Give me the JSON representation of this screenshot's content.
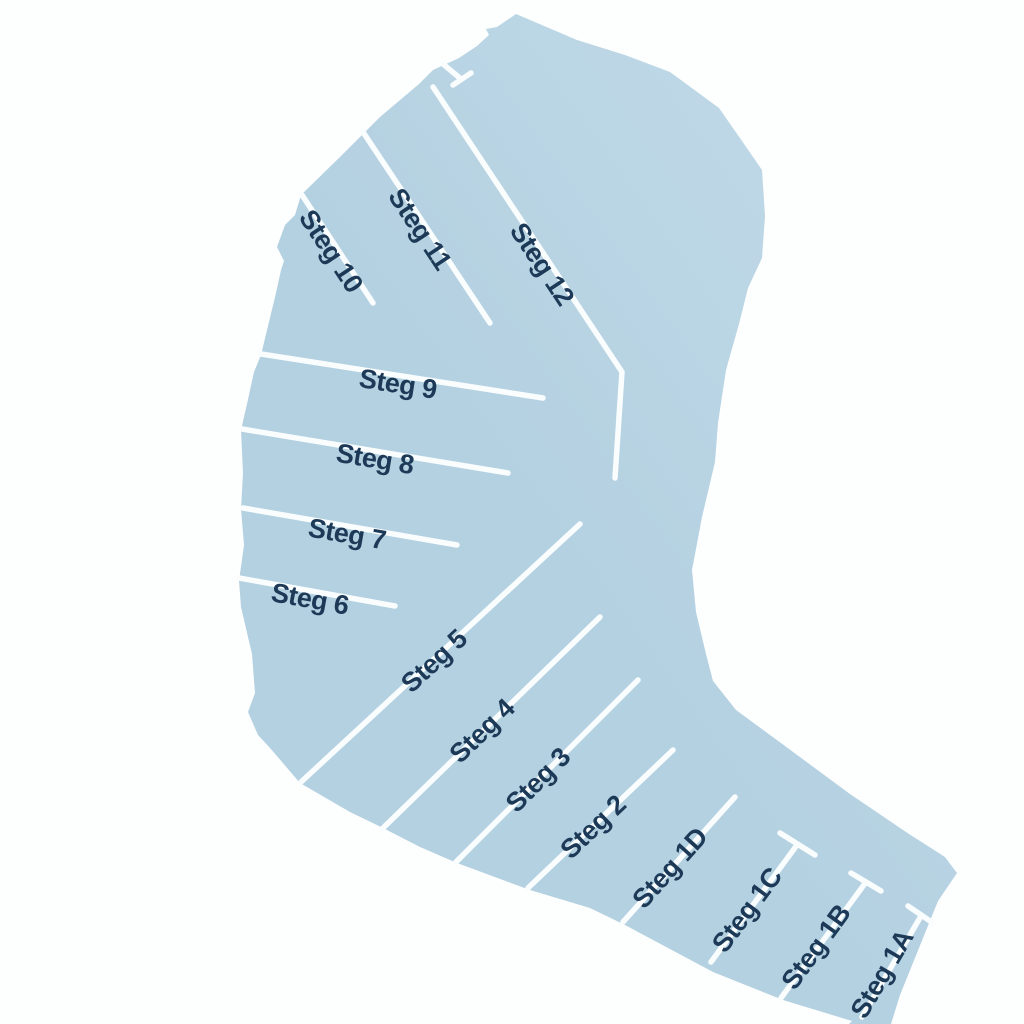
{
  "map": {
    "type": "harbor-plan",
    "background_color": "#fdfefe",
    "water_color": "#b4d1e1",
    "water_color_light": "#c3dbe9",
    "pier_line_color": "#fafdfe",
    "pier_line_width": 5.5,
    "label_color": "#1c3a57",
    "label_font_size": 27,
    "basin_outline": [
      [
        516,
        14
      ],
      [
        577,
        40
      ],
      [
        625,
        55
      ],
      [
        670,
        72
      ],
      [
        719,
        108
      ],
      [
        742,
        141
      ],
      [
        762,
        170
      ],
      [
        765,
        216
      ],
      [
        762,
        258
      ],
      [
        748,
        288
      ],
      [
        739,
        324
      ],
      [
        726,
        370
      ],
      [
        718,
        423
      ],
      [
        715,
        462
      ],
      [
        702,
        517
      ],
      [
        692,
        570
      ],
      [
        696,
        612
      ],
      [
        706,
        654
      ],
      [
        713,
        681
      ],
      [
        736,
        710
      ],
      [
        785,
        746
      ],
      [
        850,
        794
      ],
      [
        909,
        834
      ],
      [
        945,
        857
      ],
      [
        957,
        873
      ],
      [
        938,
        901
      ],
      [
        900,
        995
      ],
      [
        891,
        1024
      ],
      [
        849,
        1024
      ],
      [
        852,
        1021
      ],
      [
        783,
        1000
      ],
      [
        713,
        972
      ],
      [
        625,
        925
      ],
      [
        590,
        908
      ],
      [
        530,
        890
      ],
      [
        457,
        863
      ],
      [
        420,
        847
      ],
      [
        383,
        828
      ],
      [
        350,
        812
      ],
      [
        300,
        783
      ],
      [
        270,
        748
      ],
      [
        258,
        735
      ],
      [
        248,
        712
      ],
      [
        255,
        693
      ],
      [
        252,
        654
      ],
      [
        241,
        607
      ],
      [
        239,
        581
      ],
      [
        244,
        545
      ],
      [
        241,
        509
      ],
      [
        243,
        473
      ],
      [
        241,
        430
      ],
      [
        247,
        404
      ],
      [
        254,
        372
      ],
      [
        261,
        355
      ],
      [
        268,
        326
      ],
      [
        276,
        293
      ],
      [
        281,
        270
      ],
      [
        284,
        261
      ],
      [
        277,
        247
      ],
      [
        285,
        225
      ],
      [
        295,
        215
      ],
      [
        301,
        195
      ],
      [
        341,
        156
      ],
      [
        380,
        117
      ],
      [
        419,
        84
      ],
      [
        433,
        70
      ],
      [
        459,
        58
      ],
      [
        477,
        46
      ],
      [
        489,
        35
      ],
      [
        486,
        29
      ],
      [
        497,
        27
      ]
    ],
    "piers": [
      {
        "id": "steg-12",
        "label": "Steg 12",
        "line": [
          [
            433,
            87
          ],
          [
            622,
            372
          ],
          [
            615,
            478
          ]
        ],
        "label_pos": [
          542,
          264
        ],
        "label_rotation": 56.4
      },
      {
        "id": "steg-11",
        "label": "Steg 11",
        "line": [
          [
            363,
            132
          ],
          [
            490,
            323
          ]
        ],
        "label_pos": [
          420,
          229
        ],
        "label_rotation": 56.4
      },
      {
        "id": "steg-10",
        "label": "Steg 10",
        "line": [
          [
            302,
            195
          ],
          [
            373,
            303
          ]
        ],
        "label_pos": [
          331,
          251
        ],
        "label_rotation": 56.6
      },
      {
        "id": "steg-9",
        "label": "Steg 9",
        "line": [
          [
            261,
            354
          ],
          [
            543,
            398
          ]
        ],
        "label_pos": [
          398,
          384
        ],
        "label_rotation": 8.9
      },
      {
        "id": "steg-8",
        "label": "Steg 8",
        "line": [
          [
            242,
            429
          ],
          [
            508,
            473
          ]
        ],
        "label_pos": [
          375,
          459
        ],
        "label_rotation": 9.4
      },
      {
        "id": "steg-7",
        "label": "Steg 7",
        "line": [
          [
            243,
            508
          ],
          [
            457,
            545
          ]
        ],
        "label_pos": [
          347,
          534
        ],
        "label_rotation": 9.8
      },
      {
        "id": "steg-6",
        "label": "Steg 6",
        "line": [
          [
            239,
            578
          ],
          [
            395,
            606
          ]
        ],
        "label_pos": [
          310,
          599
        ],
        "label_rotation": 10.2
      },
      {
        "id": "steg-5",
        "label": "Steg 5",
        "line": [
          [
            301,
            782
          ],
          [
            580,
            524
          ]
        ],
        "label_pos": [
          434,
          661
        ],
        "label_rotation": -42.8
      },
      {
        "id": "steg-4",
        "label": "Steg 4",
        "line": [
          [
            382,
            829
          ],
          [
            600,
            617
          ]
        ],
        "label_pos": [
          482,
          731
        ],
        "label_rotation": -44.2
      },
      {
        "id": "steg-3",
        "label": "Steg 3",
        "line": [
          [
            456,
            862
          ],
          [
            638,
            680
          ]
        ],
        "label_pos": [
          538,
          780
        ],
        "label_rotation": -45
      },
      {
        "id": "steg-2",
        "label": "Steg 2",
        "line": [
          [
            528,
            888
          ],
          [
            673,
            750
          ]
        ],
        "label_pos": [
          593,
          827
        ],
        "label_rotation": -43.6
      },
      {
        "id": "steg-1d",
        "label": "Steg 1D",
        "line": [
          [
            623,
            922
          ],
          [
            735,
            797
          ]
        ],
        "label_pos": [
          670,
          868
        ],
        "label_rotation": -48.1
      },
      {
        "id": "steg-1c",
        "label": "Steg 1C",
        "line": [
          [
            711,
            962
          ],
          [
            797,
            845
          ]
        ],
        "crossbar": [
          [
            780,
            833
          ],
          [
            815,
            855
          ]
        ],
        "label_pos": [
          747,
          910
        ],
        "label_rotation": -53.4
      },
      {
        "id": "steg-1b",
        "label": "Steg 1B",
        "line": [
          [
            781,
            998
          ],
          [
            866,
            882
          ]
        ],
        "crossbar": [
          [
            851,
            873
          ],
          [
            881,
            891
          ]
        ],
        "label_pos": [
          816,
          947
        ],
        "label_rotation": -54
      },
      {
        "id": "steg-1a",
        "label": "Steg 1A",
        "line": [
          [
            862,
            1017
          ],
          [
            921,
            916
          ]
        ],
        "crossbar": [
          [
            908,
            906
          ],
          [
            933,
            923
          ]
        ],
        "label_pos": [
          882,
          974
        ],
        "label_rotation": -59.7
      }
    ],
    "structures": [
      {
        "id": "entrance-jetty",
        "line": [
          [
            443,
            64
          ],
          [
            461,
            79
          ]
        ],
        "crossbar": [
          [
            453,
            85
          ],
          [
            471,
            73
          ]
        ]
      }
    ]
  }
}
